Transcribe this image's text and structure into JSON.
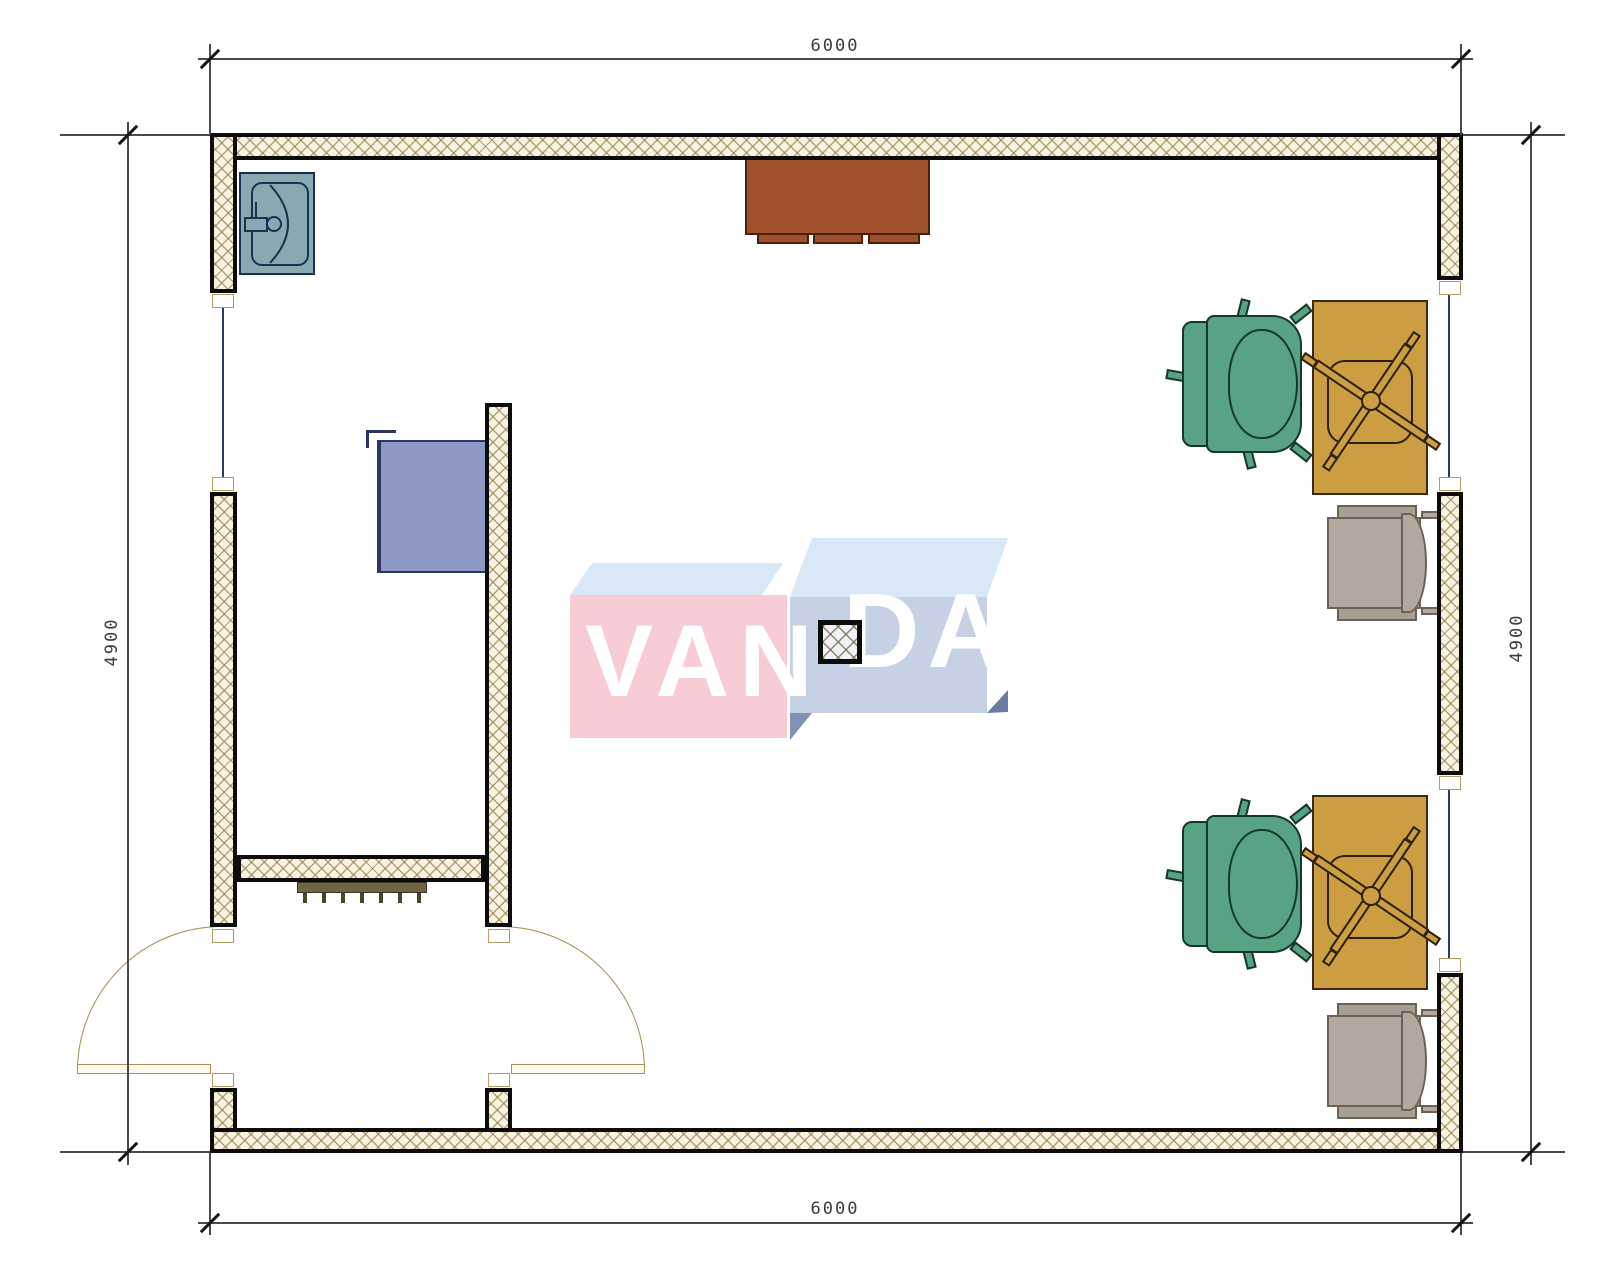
{
  "dimensions": {
    "top": {
      "value": "6000"
    },
    "bottom": {
      "value": "6000"
    },
    "left": {
      "value": "4900"
    },
    "right": {
      "value": "4900"
    }
  },
  "watermark": {
    "text": "VANDA",
    "left_part": "VAN",
    "right_part": "DA",
    "letter_color": "#ffffff",
    "box_left_front_color": "#f7ccd4",
    "box_right_front_color": "#c7d1e6",
    "box_top_color": "#d8e8f7"
  },
  "colors": {
    "wall_fill": "#f7f2e2",
    "wall_hatch": "#948048",
    "wall_border": "#0d0d0d",
    "window_line": "#2c3a66",
    "sink": "#87a9b2",
    "sideboard": "#a0512c",
    "wall_cabinet": "#8d99c4",
    "desk": "#cd9d41",
    "chair_green": "#58a383",
    "chair_gray": "#b2a89d",
    "radiator": "#6f6540",
    "door_leaf": "#fdf8ec",
    "dimension_text": "#3a3a3a"
  },
  "plan_contents": {
    "room_width_mm": 6000,
    "room_depth_mm": 4900,
    "fixtures": [
      "corner wash basin",
      "wall cabinet",
      "brown sideboard",
      "radiator",
      "square column"
    ],
    "furniture": [
      "2 desks with swivel task chairs",
      "2 green office armchairs",
      "2 gray side chairs"
    ],
    "openings": [
      "2 swing doors at bottom left",
      "1 window in left wall",
      "2 windows in right wall"
    ]
  }
}
